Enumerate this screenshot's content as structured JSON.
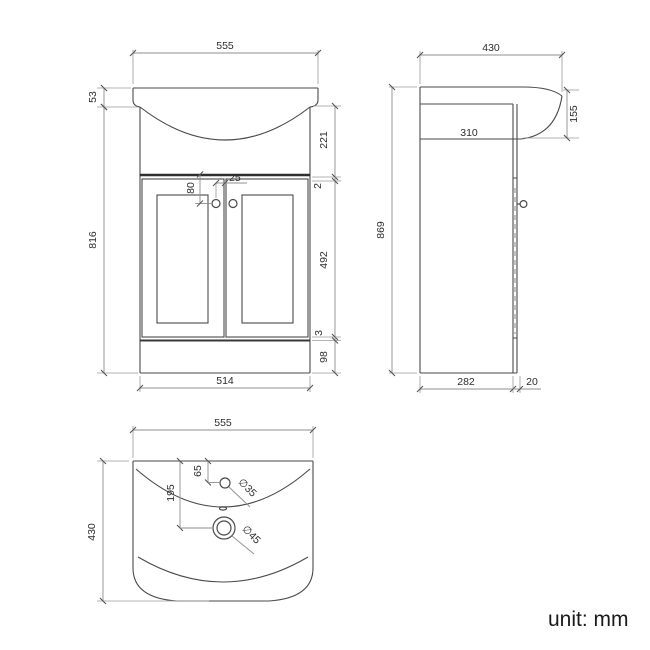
{
  "drawing": {
    "subject": "vanity-basin-unit-dimension-drawing",
    "unit_note": "unit: mm",
    "views": {
      "front": {
        "dims": {
          "width_top": "555",
          "lip_height": "53",
          "cabinet_height": "816",
          "basin_zone_height": "221",
          "gap_top": "2",
          "door_height": "492",
          "gap_bottom": "3",
          "plinth_height": "98",
          "width_bottom": "514",
          "handle_gap": "25",
          "handle_drop": "80"
        }
      },
      "side": {
        "dims": {
          "depth_top": "430",
          "total_height": "869",
          "inner_depth": "310",
          "basin_side_height": "155",
          "body_depth": "282",
          "door_thickness": "20"
        }
      },
      "plan": {
        "dims": {
          "width": "555",
          "depth": "430",
          "tap_hole_offset": "65",
          "drain_offset": "195",
          "tap_hole_diameter": "∅35",
          "drain_diameter": "∅45"
        }
      }
    },
    "colors": {
      "background": "#ffffff",
      "outline": "#4a4a4a",
      "thick_line": "#2f2f2f",
      "dimension_line": "#8f8f8f",
      "text": "#2d2d2d"
    }
  }
}
